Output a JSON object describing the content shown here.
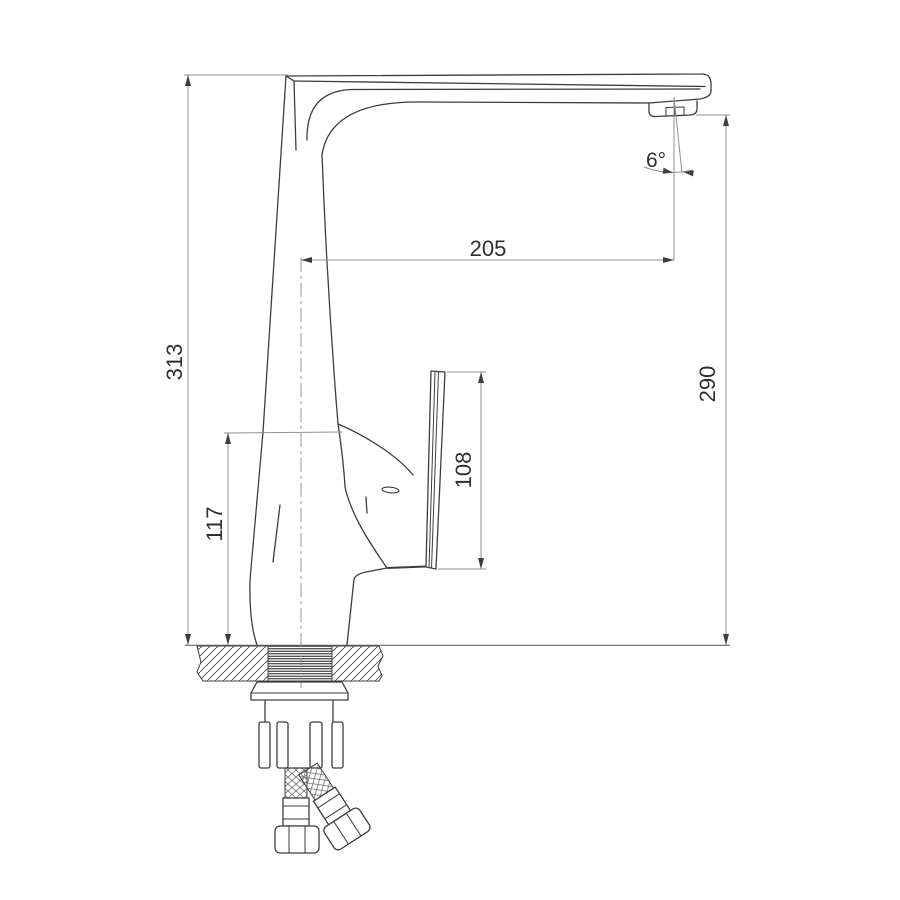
{
  "drawing": {
    "subject": "single-lever kitchen faucet, side elevation with installation parts",
    "style": {
      "background": "#ffffff",
      "line_color": "#3d3d3d",
      "dimension_line_color": "#8f8f8f",
      "text_color": "#2e2e2e"
    },
    "dimensions": [
      {
        "id": "spout-reach",
        "value": "205",
        "orientation": "horizontal"
      },
      {
        "id": "spray-angle",
        "value": "6°",
        "orientation": "angular"
      },
      {
        "id": "overall-height",
        "value": "313",
        "orientation": "vertical"
      },
      {
        "id": "outlet-height",
        "value": "290",
        "orientation": "vertical"
      },
      {
        "id": "body-height",
        "value": "117",
        "orientation": "vertical"
      },
      {
        "id": "handle-span",
        "value": "108",
        "orientation": "vertical"
      }
    ]
  }
}
